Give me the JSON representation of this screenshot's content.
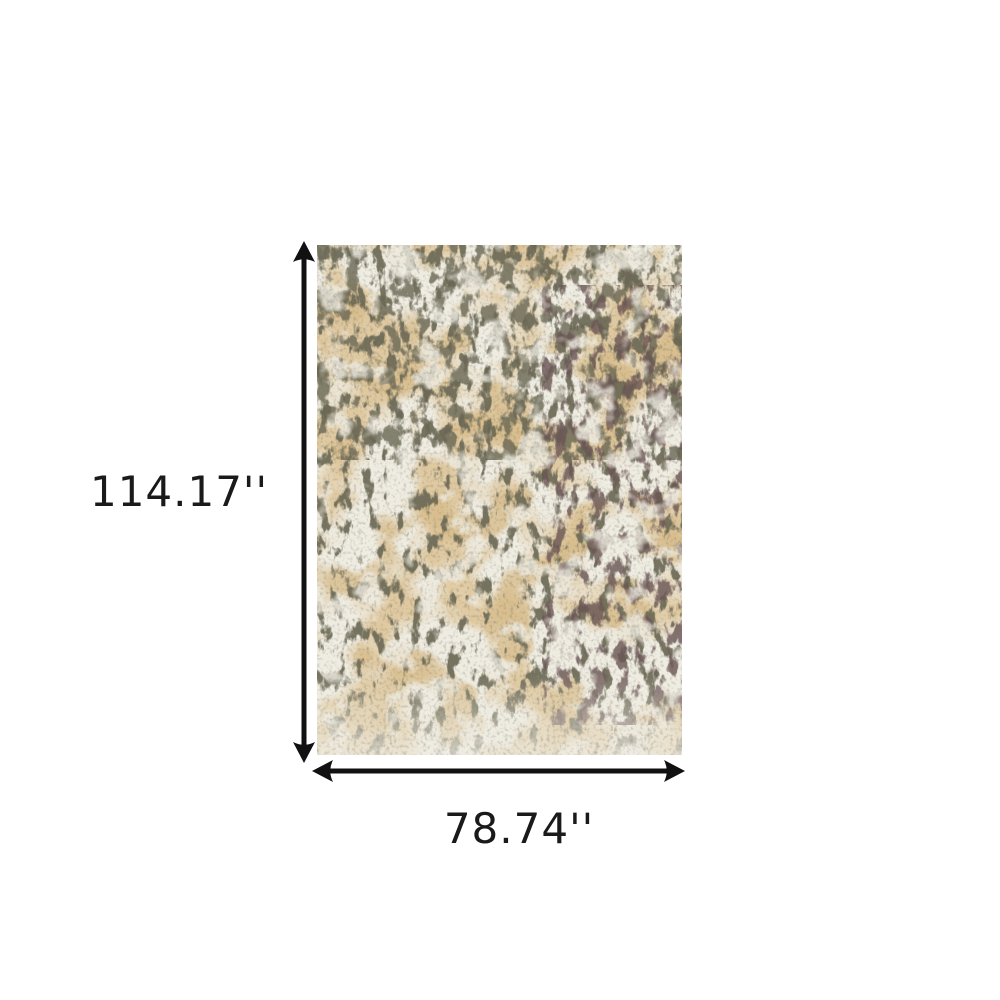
{
  "canvas": {
    "background_color": "#ffffff"
  },
  "dimensions": {
    "height": {
      "label": "114.17''"
    },
    "width": {
      "label": "78.74''"
    },
    "arrow_color": "#111111",
    "label_color": "#1a1a1a"
  },
  "rug": {
    "colors": {
      "base_cream": "#EFECE2",
      "tan": "#DFC89E",
      "dark_tan": "#D8BD8C",
      "olive_motif": "#696754",
      "speckle": "#6F6C58"
    }
  }
}
